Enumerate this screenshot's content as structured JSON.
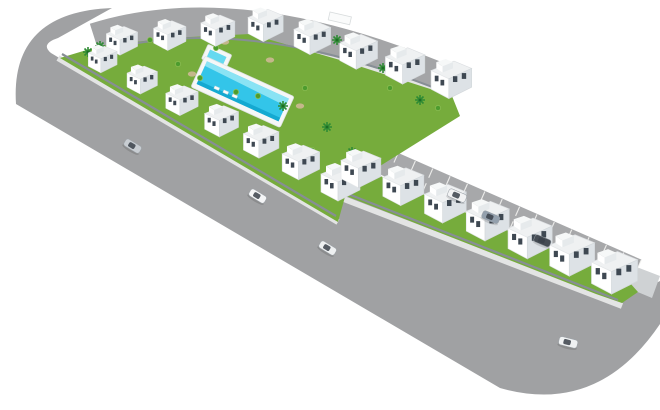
{
  "scene": {
    "description": "Aerial 3D render of an L-shaped residential development of white townhouses with central lawn courtyard and swimming pool, surrounded by gray roads, parking strip with bays, cars and palm trees",
    "background": "#ffffff"
  },
  "colors": {
    "road": "#a0a1a3",
    "road_top": "#a4a5a7",
    "parking": "#a7a8aa",
    "parking_line": "#f4f4f2",
    "curb": "#e3e4e4",
    "wall": "#878e95",
    "ledge": "#cfd2d4",
    "grass": "#76ac3c",
    "grass_light": "#8fbf55",
    "patch_tan": "#cdb892",
    "pool_deck": "#f6f7f7",
    "pool_water": "#33c5e9",
    "pool_shallow": "#9ae8f6",
    "pool_deep": "#0fa3cd",
    "kiddie_water": "#66d9f0",
    "roof": "#eff1f2",
    "roof_edge": "#dcdfe2",
    "face_light": "#ffffff",
    "face_shade": "#dde2e6",
    "bulkhead_shade": "#e6eaec",
    "window": "#3e4852",
    "palm": "#2e8b34",
    "palm_trunk": "#1e6b24",
    "bush": "#4d9c2e",
    "car_window": "#39414a",
    "pavilion": "#fafbfb",
    "pavilion_edge": "#d8dcdd",
    "lounger": "#fbfcfc"
  },
  "roads": {
    "main_d": "M 112,8 Q 10,12 16,104 L 500,388 Q 598,416 660,324 L 660,281 L 630,296 L 597,290 L 342,188 L 333,222 L 51,53 Q 40,44 58,38 Z",
    "top_d": "M 95,40 Q 240,-6 450,84",
    "parking_d": "M 358,150 L 636,272",
    "curb_block_d": "M 58,58 L 338,222",
    "curb_arm_d": "M 336,196 L 622,306",
    "curb_top_d": "M 96,56 Q 242,14 452,98",
    "wall_block_d": "M 62,54 L 336,216",
    "wall_arm_d": "M 338,190 L 618,300",
    "wall_top_d": "M 98,52 Q 243,10 450,94",
    "green_block_pts": "60,58 100,46 170,38 250,34 340,60 452,96 460,116 348,186 338,222",
    "green_arm_pts": "350,163 630,283 638,292 622,303 596,294 336,192",
    "ledge_pts": "634,266 660,276 652,298 628,288"
  },
  "parking": {
    "tick_count": 17,
    "x0": 358,
    "y0": 150,
    "x1": 636,
    "y1": 272,
    "half_width": 13,
    "tick_len": 10
  },
  "pool": {
    "x": 205,
    "y": 56,
    "angle": 24.5,
    "deck_w": 98,
    "deck_h": 34,
    "water_w": 90,
    "water_h": 25,
    "kiddie_w": 26,
    "kiddie_h": 16
  },
  "buildings": {
    "unit_count_total": 22,
    "rows": [
      {
        "name": "row-top",
        "pts": [
          [
            104,
            24
          ],
          [
            250,
            6
          ],
          [
            428,
            58
          ]
        ],
        "count": 8,
        "s0": 0.8,
        "s1": 1.04
      },
      {
        "name": "row-left",
        "pts": [
          [
            86,
            44
          ],
          [
            318,
            162
          ]
        ],
        "count": 7,
        "s0": 0.74,
        "s1": 1.0
      },
      {
        "name": "row-arm",
        "pts": [
          [
            338,
            148
          ],
          [
            588,
            248
          ]
        ],
        "count": 7,
        "s0": 1.02,
        "s1": 1.18
      }
    ]
  },
  "cars": [
    {
      "x": 127,
      "y": 138,
      "angle": 31,
      "color": "#c8cdd2",
      "s": 1.0,
      "where": "main-road"
    },
    {
      "x": 252,
      "y": 188,
      "angle": 31,
      "color": "#f4f5f6",
      "s": 1.0,
      "where": "main-road"
    },
    {
      "x": 322,
      "y": 240,
      "angle": 31,
      "color": "#eef0f1",
      "s": 1.0,
      "where": "main-road"
    },
    {
      "x": 450,
      "y": 188,
      "angle": 23,
      "color": "#f2f3f4",
      "s": 1.05,
      "where": "parking"
    },
    {
      "x": 484,
      "y": 210,
      "angle": 23,
      "color": "#93a0ad",
      "s": 1.0,
      "where": "parking"
    },
    {
      "x": 536,
      "y": 234,
      "angle": 23,
      "color": "#454c54",
      "s": 0.95,
      "where": "parking"
    },
    {
      "x": 560,
      "y": 336,
      "angle": 14,
      "color": "#eff1f2",
      "s": 1.05,
      "where": "bottom-road"
    }
  ],
  "vegetation": {
    "palms": [
      [
        88,
        52
      ],
      [
        100,
        46
      ],
      [
        337,
        40
      ],
      [
        383,
        68
      ],
      [
        283,
        106
      ],
      [
        327,
        127
      ],
      [
        352,
        152
      ],
      [
        420,
        100
      ]
    ],
    "bushes": [
      [
        150,
        40
      ],
      [
        164,
        46
      ],
      [
        216,
        48
      ],
      [
        236,
        92
      ],
      [
        258,
        96
      ],
      [
        305,
        88
      ],
      [
        200,
        78
      ],
      [
        178,
        64
      ],
      [
        390,
        88
      ],
      [
        438,
        108
      ],
      [
        312,
        150
      ]
    ],
    "patches": [
      [
        192,
        74
      ],
      [
        243,
        94
      ],
      [
        270,
        60
      ],
      [
        300,
        106
      ],
      [
        225,
        42
      ]
    ]
  },
  "furniture": {
    "pavilions": [
      {
        "x": 168,
        "y": 30,
        "w": 14,
        "h": 7,
        "angle": 13
      },
      {
        "x": 330,
        "y": 12,
        "w": 22,
        "h": 8,
        "angle": 13
      }
    ],
    "loungers": [
      [
        215,
        86
      ],
      [
        224,
        90
      ],
      [
        233,
        94
      ]
    ]
  }
}
